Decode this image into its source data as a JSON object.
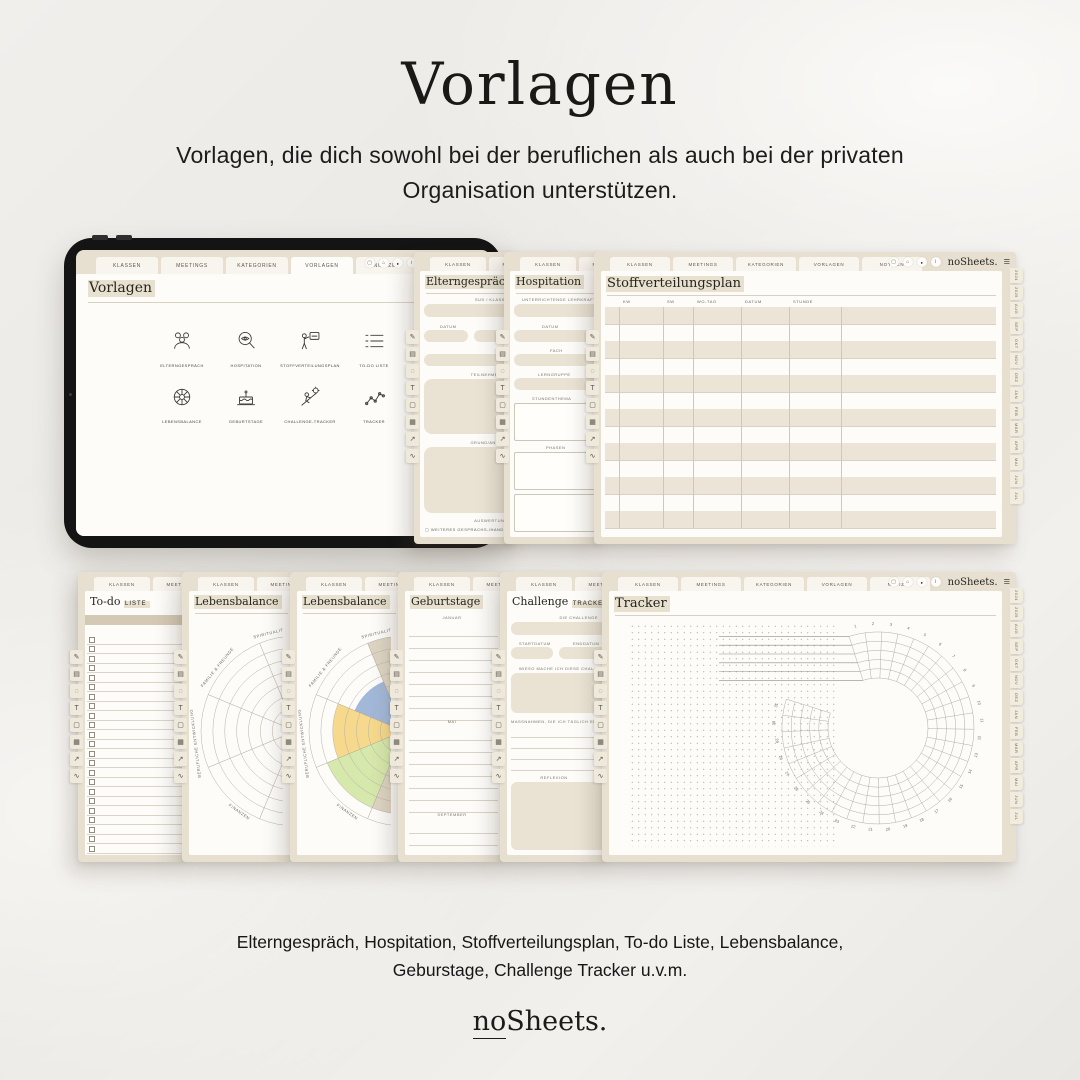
{
  "header": {
    "title": "Vorlagen",
    "subtitle_line1": "Vorlagen, die dich sowohl bei der beruflichen als auch bei der privaten",
    "subtitle_line2": "Organisation unterstützen."
  },
  "brand": {
    "wordmark": "noSheets.",
    "wordmark_no": "no",
    "wordmark_sheets": "Sheets."
  },
  "app_tabs": [
    "KLASSEN",
    "MEETINGS",
    "KATEGORIEN",
    "VORLAGEN",
    "NOTIZEN"
  ],
  "toolbar": {
    "buttons": [
      {
        "name": "window-icon",
        "glyph": "▢"
      },
      {
        "name": "home-icon",
        "glyph": "⌂"
      },
      {
        "name": "record-icon",
        "glyph": "●"
      },
      {
        "name": "info-icon",
        "glyph": "i"
      }
    ],
    "wordmark": "noSheets.",
    "menu_icon": "≡"
  },
  "rail": [
    {
      "name": "pen-icon",
      "glyph": "✎"
    },
    {
      "name": "highlighter-icon",
      "glyph": "▤"
    },
    {
      "name": "eraser-icon",
      "glyph": "◌"
    },
    {
      "name": "text-icon",
      "glyph": "T"
    },
    {
      "name": "shape-icon",
      "glyph": "▢"
    },
    {
      "name": "image-icon",
      "glyph": "▦"
    },
    {
      "name": "arrow-icon",
      "glyph": "↗"
    },
    {
      "name": "chart-icon",
      "glyph": "∿"
    }
  ],
  "tablet": {
    "page_title": "Vorlagen",
    "active_tab": "VORLAGEN",
    "templates": [
      {
        "label": "ELTERNGESPRÄCH",
        "icon": "people-icon"
      },
      {
        "label": "HOSPITATION",
        "icon": "eye-magnifier-icon"
      },
      {
        "label": "STOFFVERTEILUNGSPLAN",
        "icon": "presenter-icon"
      },
      {
        "label": "TO-DO LISTE",
        "icon": "list-icon"
      },
      {
        "label": "LEBENSBALANCE",
        "icon": "wheel-icon"
      },
      {
        "label": "GEBURTSTAGE",
        "icon": "cake-icon"
      },
      {
        "label": "CHALLENGE-TRACKER",
        "icon": "challenge-icon"
      },
      {
        "label": "TRACKER",
        "icon": "trend-icon"
      }
    ]
  },
  "pages": {
    "elterngespraech": {
      "title": "Elterngespräch",
      "fields": [
        "SUS / KLASSE",
        "DATUM",
        "ORT",
        "TEILNEHMENDE",
        "GRUND/ANLASS",
        "AUSWERTUNG"
      ],
      "checkbox_items": [
        {
          "glyph": "▢",
          "text": "WEITERES GESPRÄCHS-/HANDLUNGSBEDARF"
        },
        {
          "glyph": "◯",
          "text": "KEIN WEITERES GESPRÄCHS-/HANDLUNGSB."
        }
      ]
    },
    "hospitation": {
      "title": "Hospitation",
      "fields": [
        "UNTERRICHTENDE LEHRKRAFT",
        "DATUM",
        "FACH",
        "LERNGRUPPE",
        "STUNDENTHEMA",
        "PHASEN"
      ]
    },
    "stoffverteilungsplan": {
      "title": "Stoffverteilungsplan",
      "columns": [
        "KW",
        "SW",
        "WO-TAG",
        "DATUM",
        "STUNDE"
      ],
      "row_count": 13,
      "side_tabs": [
        "2024",
        "2025",
        "AUG",
        "SEP",
        "OKT",
        "NOV",
        "DEZ",
        "JAN",
        "FEB",
        "MÄR",
        "APR",
        "MAI",
        "JUN",
        "JUL"
      ]
    },
    "todo": {
      "title_serif": "To-do",
      "title_caps": "LISTE",
      "row_count": 26
    },
    "lebensbalance": {
      "title": "Lebensbalance"
    },
    "geburtstage": {
      "title": "Geburtstage",
      "months": [
        "JANUAR",
        "MAI",
        "SEPTEMBER"
      ],
      "lines_per_section": [
        8,
        7,
        7
      ]
    },
    "challenge": {
      "title_serif": "Challenge",
      "title_caps": "TRACKER",
      "labels": {
        "challenge": "DIE CHALLENGE",
        "start": "STARTDATUM",
        "end": "ENDDATUM",
        "why": "WIESO MACHE ICH DIESE CHALLENGE?",
        "measures": "MASSNAHMEN, DIE ICH TÄGLICH ERLEDIGE",
        "reflection": "REFLEXION"
      },
      "measure_line_count": 4
    },
    "tracker": {
      "title": "Tracker"
    }
  },
  "chart_data": [
    {
      "type": "radial-wheel",
      "title": "Lebensbalance",
      "variant": "empty",
      "rings": 8,
      "sectors": 8,
      "visible_labels": [
        "SPIRITUALITÄT",
        "FAMILIE & FREUNDE",
        "BERUFLICHE ENTWICKLUNG",
        "FINANZEN"
      ],
      "label_angles_deg": [
        104,
        141,
        187,
        235
      ]
    },
    {
      "type": "radial-wheel",
      "title": "Lebensbalance",
      "variant": "filled",
      "rings": 8,
      "sectors": 8,
      "visible_labels": [
        "SPIRITUALITÄT",
        "FAMILIE & FREUNDE",
        "BERUFLICHE ENTWICKLUNG",
        "FINANZEN"
      ],
      "label_angles_deg": [
        104,
        141,
        187,
        235
      ],
      "filled_sectors": [
        {
          "angle_center_deg": 90,
          "level": 8,
          "color": "#d8ccba"
        },
        {
          "angle_center_deg": 135,
          "level": 4.5,
          "color": "#92abd6"
        },
        {
          "angle_center_deg": 180,
          "level": 6,
          "color": "#f4d279"
        },
        {
          "angle_center_deg": 225,
          "level": 7,
          "color": "#cfe49d"
        },
        {
          "angle_center_deg": 45,
          "level": 8,
          "color": "#cfe49d"
        },
        {
          "angle_center_deg": 270,
          "level": 7,
          "color": "#d8ccba"
        }
      ]
    },
    {
      "type": "circular-habit-tracker",
      "title": "Tracker",
      "days": 31,
      "rings": 5,
      "first_day_label": 1,
      "last_day_label": 31,
      "gap_position": "top-left",
      "habit_line_count": 5
    }
  ],
  "footer": {
    "line1": "Elterngespräch, Hospitation, Stoffverteilungsplan, To-do Liste, Lebensbalance,",
    "line2": "Geburstage, Challenge Tracker u.v.m."
  }
}
